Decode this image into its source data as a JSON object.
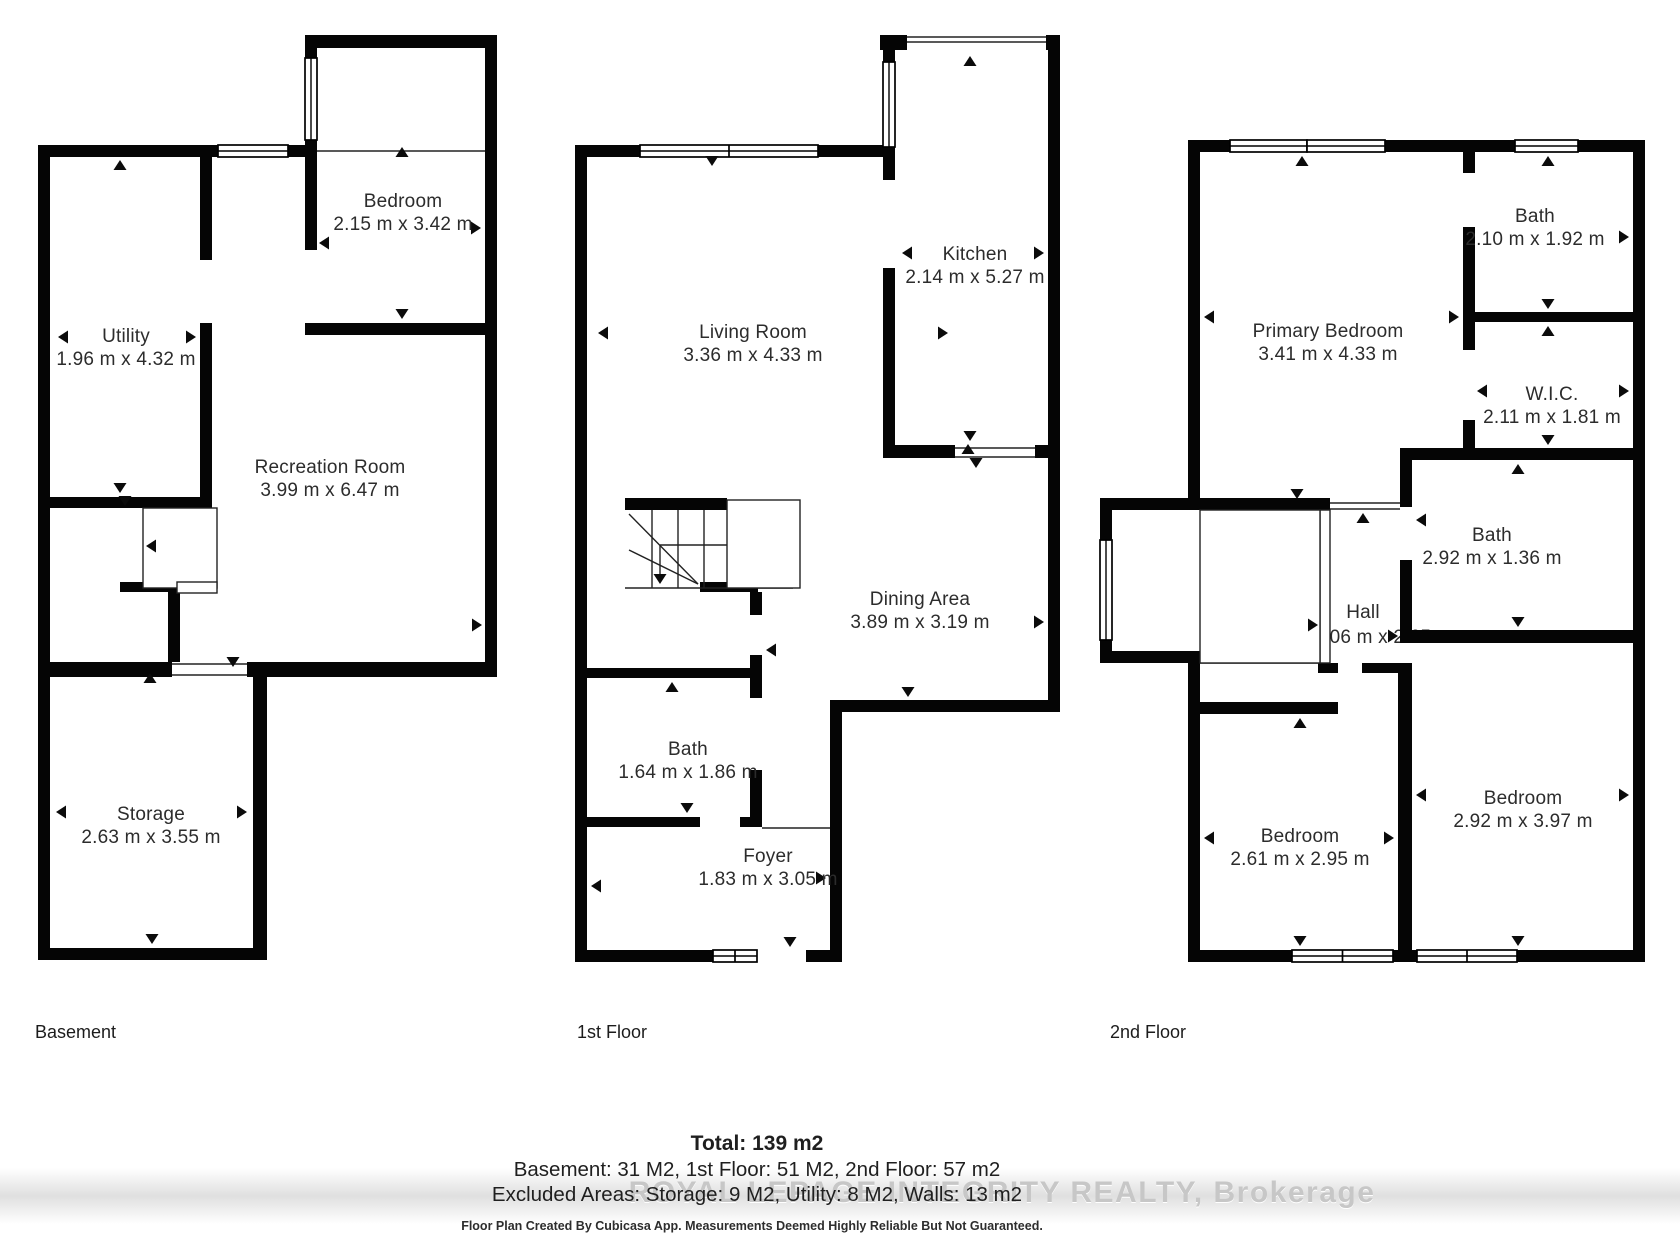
{
  "basement": {
    "label": "Basement",
    "rooms": {
      "bedroom": {
        "name": "Bedroom",
        "dims": "2.15 m x 3.42 m"
      },
      "utility": {
        "name": "Utility",
        "dims": "1.96 m x 4.32 m"
      },
      "recreation": {
        "name": "Recreation Room",
        "dims": "3.99 m x 6.47 m"
      },
      "storage": {
        "name": "Storage",
        "dims": "2.63 m x 3.55 m"
      }
    }
  },
  "first_floor": {
    "label": "1st Floor",
    "rooms": {
      "kitchen": {
        "name": "Kitchen",
        "dims": "2.14 m x 5.27 m"
      },
      "living": {
        "name": "Living Room",
        "dims": "3.36 m x 4.33 m"
      },
      "dining": {
        "name": "Dining Area",
        "dims": "3.89 m x 3.19 m"
      },
      "bath": {
        "name": "Bath",
        "dims": "1.64 m x 1.86 m"
      },
      "foyer": {
        "name": "Foyer",
        "dims": "1.83 m x 3.05 m"
      }
    }
  },
  "second_floor": {
    "label": "2nd Floor",
    "rooms": {
      "primary_bedroom": {
        "name": "Primary Bedroom",
        "dims": "3.41 m x 4.33 m"
      },
      "bath_top": {
        "name": "Bath",
        "dims": "2.10 m x 1.92 m"
      },
      "wic": {
        "name": "W.I.C.",
        "dims": "2.11 m x 1.81 m"
      },
      "bath_mid": {
        "name": "Bath",
        "dims": "2.92 m x 1.36 m"
      },
      "hall": {
        "name": "Hall",
        "dims": "1.06 m x 2.65 m"
      },
      "bedroom_left": {
        "name": "Bedroom",
        "dims": "2.61 m x 2.95 m"
      },
      "bedroom_right": {
        "name": "Bedroom",
        "dims": "2.92 m x 3.97 m"
      }
    }
  },
  "summary": {
    "total": "Total: 139 m2",
    "floors": "Basement: 31 M2, 1st Floor: 51 M2, 2nd Floor: 57 m2",
    "excluded": "Excluded Areas: Storage: 9 M2, Utility: 8 M2, Walls: 13 m2"
  },
  "watermark": "ROYAL LEPAGE INTEGRITY REALTY, Brokerage",
  "footer": "Floor Plan Created By Cubicasa App. Measurements Deemed Highly Reliable But Not Guaranteed.",
  "colors": {
    "wall": "#050505",
    "text": "#2c2c2c",
    "watermark": "#c7c7c7"
  }
}
